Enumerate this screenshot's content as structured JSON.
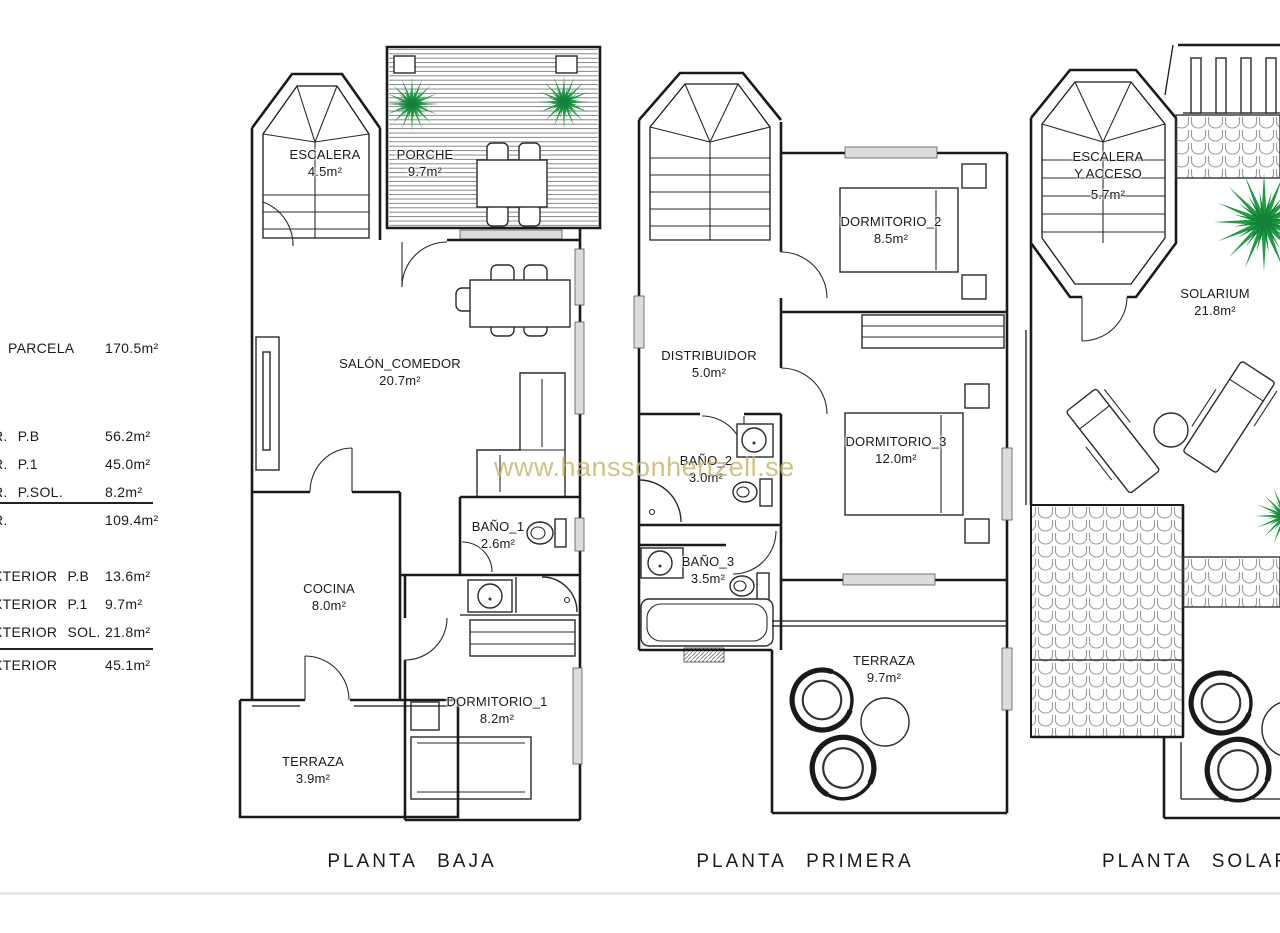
{
  "page": {
    "watermark": "www.hanssonhertzell.se",
    "watermark_color": "#c8b266",
    "palm_green": "#1d9c40",
    "line_black": "#1a1a1a"
  },
  "area_table": {
    "rows": [
      {
        "label": "PARCELA",
        "value": "170.5m²"
      },
      {
        "label": "R. P.B",
        "value": "56.2m²"
      },
      {
        "label": "R. P.1",
        "value": "45.0m²"
      },
      {
        "label": "R. P.SOL.",
        "value": "8.2m²"
      },
      {
        "label": "R.",
        "value": "109.4m²"
      },
      {
        "label": "XTERIOR P.B",
        "value": "13.6m²"
      },
      {
        "label": "XTERIOR P.1",
        "value": "9.7m²"
      },
      {
        "label": "XTERIOR SOL.",
        "value": "21.8m²"
      },
      {
        "label": "XTERIOR",
        "value": "45.1m²"
      }
    ]
  },
  "floors": {
    "baja": {
      "title": "PLANTA BAJA",
      "rooms": {
        "escalera": {
          "name": "ESCALERA",
          "area": "4.5m²"
        },
        "porche": {
          "name": "PORCHE",
          "area": "9.7m²"
        },
        "salon": {
          "name": "SALÓN_COMEDOR",
          "area": "20.7m²"
        },
        "bano1": {
          "name": "BAÑO_1",
          "area": "2.6m²"
        },
        "cocina": {
          "name": "COCINA",
          "area": "8.0m²"
        },
        "dormitorio1": {
          "name": "DORMITORIO_1",
          "area": "8.2m²"
        },
        "terraza": {
          "name": "TERRAZA",
          "area": "3.9m²"
        }
      }
    },
    "primera": {
      "title": "PLANTA PRIMERA",
      "rooms": {
        "dormitorio2": {
          "name": "DORMITORIO_2",
          "area": "8.5m²"
        },
        "distribuidor": {
          "name": "DISTRIBUIDOR",
          "area": "5.0m²"
        },
        "bano2": {
          "name": "BAÑO_2",
          "area": "3.0m²"
        },
        "dormitorio3": {
          "name": "DORMITORIO_3",
          "area": "12.0m²"
        },
        "bano3": {
          "name": "BAÑO_3",
          "area": "3.5m²"
        },
        "terraza": {
          "name": "TERRAZA",
          "area": "9.7m²"
        }
      }
    },
    "solarium": {
      "title": "PLANTA SOLARIUM",
      "rooms": {
        "escalera": {
          "name": "ESCALERA",
          "name2": "Y ACCESO",
          "area": "5.7m²"
        },
        "solarium": {
          "name": "SOLARIUM",
          "area": "21.8m²"
        }
      }
    }
  }
}
